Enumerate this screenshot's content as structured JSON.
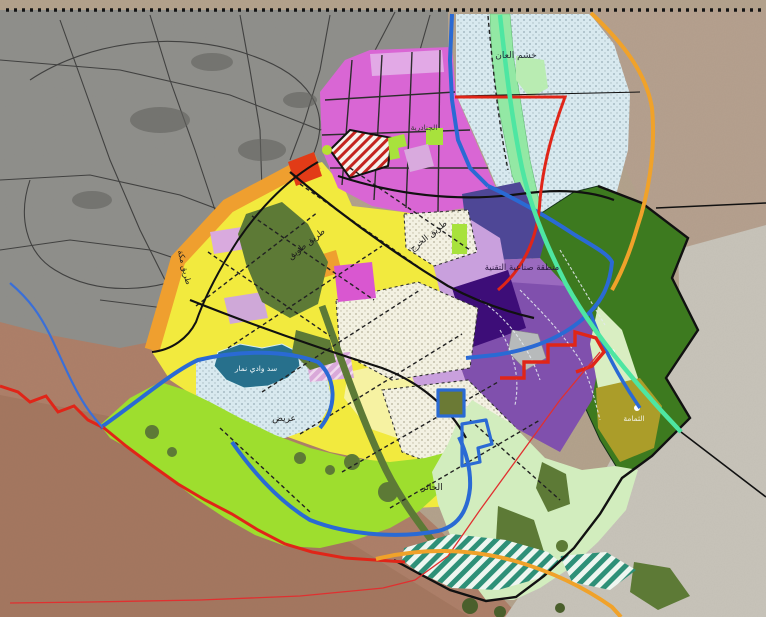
{
  "map": {
    "labels": {
      "khashm_alaan": "خشم العان",
      "janadriyah": "الجنادرية",
      "tuwaiq_road": "طريق طويق",
      "kharj_road": "طريق الخرج",
      "makkah_road": "طريق مكة",
      "tech_zone": "منطقة صناعية التقنية",
      "namar_dam": "سد وادي نمار",
      "areed": "عريض",
      "al_hair": "الحائر",
      "thumamah": "الثمامة"
    },
    "line_colors": {
      "boundary_red": "#e02518",
      "road_black": "#111111",
      "blue_line": "#2a6ad4",
      "orange_road": "#f0a22a",
      "green_corridor": "#4ee6a2",
      "thin_red": "#e03030"
    },
    "zone_colors": {
      "existing_city_gray": "#90908c",
      "yellow_zone": "#f2ea3e",
      "pale_yellow_zone": "#f6f2a2",
      "magenta_zone": "#d957d0",
      "lavender_zone": "#d9aade",
      "orange_band": "#ef9f2f",
      "red_zone": "#e23b17",
      "slate_purple_zone": "#4e4796",
      "medium_purple_zone": "#8050ad",
      "dark_purple_zone": "#3d0d78",
      "lime_green_zone": "#9ede2e",
      "dark_green_reserve": "#3d7a1f",
      "wadi_vegetation": "#5d7a36",
      "pale_mint_zone": "#d2edbe",
      "olive_zone": "#ab9d29",
      "pale_blue_dotted_zone": "#d8e9ef",
      "teal_hatch_zone": "#2e9078",
      "lake_teal": "#27708c"
    }
  }
}
